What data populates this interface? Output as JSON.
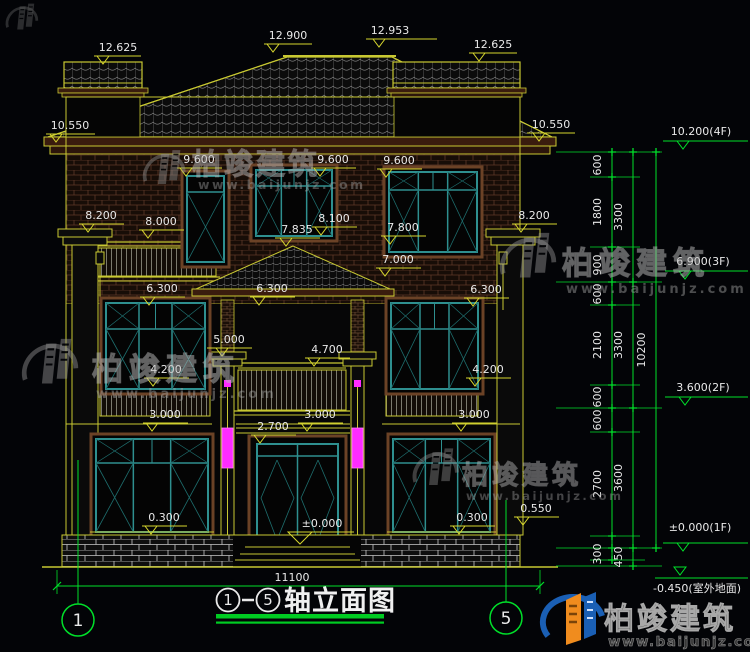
{
  "drawing_title": {
    "bubble_left": "1",
    "bubble_right": "5",
    "label": "轴立面图"
  },
  "brand": {
    "name_cn": "柏竣建筑",
    "website": "www.baijunjz.com"
  },
  "bottom_dim": {
    "text": "11100",
    "x": 292,
    "y": 581
  },
  "axis_bubbles": [
    {
      "label": "1",
      "cx": 78,
      "cy": 620
    },
    {
      "label": "5",
      "cx": 506,
      "cy": 618
    }
  ],
  "yellow_level_marks": [
    {
      "text": "12.625",
      "x": 118,
      "y": 51,
      "line": [
        94,
        141,
        56
      ],
      "tc": 103
    },
    {
      "text": "12.900",
      "x": 288,
      "y": 39,
      "line": [
        264,
        312,
        44
      ],
      "tc": 273
    },
    {
      "text": "12.953",
      "x": 390,
      "y": 34,
      "line": [
        366,
        437,
        39
      ],
      "tc": 379
    },
    {
      "text": "12.625",
      "x": 493,
      "y": 48,
      "line": [
        469,
        517,
        53
      ],
      "tc": 479
    },
    {
      "text": "10.550",
      "x": 70,
      "y": 129,
      "line": [
        46,
        95,
        134
      ],
      "tc": 56
    },
    {
      "text": "10.550",
      "x": 551,
      "y": 128,
      "line": [
        527,
        575,
        133
      ],
      "tc": 539
    },
    {
      "text": "9.600",
      "x": 199,
      "y": 163,
      "line": [
        177,
        222,
        168
      ],
      "tc": 186
    },
    {
      "text": "9.600",
      "x": 333,
      "y": 163,
      "line": [
        311,
        356,
        168
      ],
      "tc": 320
    },
    {
      "text": "9.600",
      "x": 399,
      "y": 164,
      "line": [
        377,
        422,
        169
      ],
      "tc": 386
    },
    {
      "text": "8.200",
      "x": 101,
      "y": 219,
      "line": [
        79,
        124,
        224
      ],
      "tc": 88
    },
    {
      "text": "8.000",
      "x": 161,
      "y": 225,
      "line": [
        139,
        184,
        230
      ],
      "tc": 148
    },
    {
      "text": "8.100",
      "x": 334,
      "y": 222,
      "line": [
        312,
        357,
        227
      ],
      "tc": 321
    },
    {
      "text": "7.835",
      "x": 297,
      "y": 233,
      "line": [
        275,
        320,
        238
      ],
      "tc": 286
    },
    {
      "text": "7.800",
      "x": 403,
      "y": 231,
      "line": [
        381,
        426,
        236
      ],
      "tc": 390
    },
    {
      "text": "8.200",
      "x": 534,
      "y": 219,
      "line": [
        512,
        557,
        224
      ],
      "tc": 521
    },
    {
      "text": "7.000",
      "x": 398,
      "y": 263,
      "line": [
        376,
        421,
        268
      ],
      "tc": 385
    },
    {
      "text": "6.300",
      "x": 162,
      "y": 292,
      "line": [
        140,
        185,
        297
      ],
      "tc": 149
    },
    {
      "text": "6.300",
      "x": 272,
      "y": 292,
      "line": [
        250,
        295,
        297
      ],
      "tc": 259
    },
    {
      "text": "6.300",
      "x": 486,
      "y": 293,
      "line": [
        464,
        509,
        298
      ],
      "tc": 473
    },
    {
      "text": "5.000",
      "x": 229,
      "y": 343,
      "line": [
        207,
        252,
        348
      ],
      "tc": 222
    },
    {
      "text": "4.700",
      "x": 327,
      "y": 353,
      "line": [
        305,
        350,
        358
      ],
      "tc": 314
    },
    {
      "text": "4.200",
      "x": 166,
      "y": 373,
      "line": [
        144,
        189,
        378
      ],
      "tc": 153
    },
    {
      "text": "4.200",
      "x": 488,
      "y": 373,
      "line": [
        466,
        511,
        378
      ],
      "tc": 475
    },
    {
      "text": "3.000",
      "x": 165,
      "y": 418,
      "line": [
        143,
        188,
        423
      ],
      "tc": 152
    },
    {
      "text": "3.000",
      "x": 320,
      "y": 418,
      "line": [
        298,
        343,
        423
      ],
      "tc": 307
    },
    {
      "text": "3.000",
      "x": 474,
      "y": 418,
      "line": [
        452,
        497,
        423
      ],
      "tc": 461
    },
    {
      "text": "2.700",
      "x": 273,
      "y": 430,
      "line": [
        251,
        296,
        435
      ],
      "tc": 260
    },
    {
      "text": "0.300",
      "x": 164,
      "y": 521,
      "line": [
        142,
        187,
        526
      ],
      "tc": 151
    },
    {
      "text": "0.300",
      "x": 472,
      "y": 521,
      "line": [
        450,
        495,
        526
      ],
      "tc": 459
    },
    {
      "text": "0.550",
      "x": 536,
      "y": 512,
      "line": [
        514,
        559,
        517
      ],
      "tc": 523
    },
    {
      "text": "±0.000",
      "x": 322,
      "y": 527,
      "line": [
        292,
        354,
        532
      ],
      "tc": 300,
      "big": true
    }
  ],
  "green_vertical_dims": [
    {
      "text": "600",
      "x": 601,
      "y": 165
    },
    {
      "text": "1800",
      "x": 601,
      "y": 212
    },
    {
      "text": "900",
      "x": 601,
      "y": 265
    },
    {
      "text": "600",
      "x": 601,
      "y": 294
    },
    {
      "text": "2100",
      "x": 601,
      "y": 345
    },
    {
      "text": "600",
      "x": 601,
      "y": 397
    },
    {
      "text": "600",
      "x": 601,
      "y": 420
    },
    {
      "text": "2700",
      "x": 601,
      "y": 484
    },
    {
      "text": "300",
      "x": 601,
      "y": 554
    },
    {
      "text": "3300",
      "x": 622,
      "y": 217
    },
    {
      "text": "3300",
      "x": 622,
      "y": 345
    },
    {
      "text": "3600",
      "x": 622,
      "y": 478
    },
    {
      "text": "450",
      "x": 622,
      "y": 557
    },
    {
      "text": "10200",
      "x": 645,
      "y": 350
    }
  ],
  "green_level_marks": [
    {
      "text": "10.200(4F)",
      "x": 701,
      "y": 135,
      "line": [
        663,
        748,
        141
      ],
      "tc": 683
    },
    {
      "text": "6.900(3F)",
      "x": 703,
      "y": 265,
      "line": [
        665,
        748,
        271
      ],
      "tc": 685
    },
    {
      "text": "3.600(2F)",
      "x": 703,
      "y": 391,
      "line": [
        665,
        748,
        397
      ],
      "tc": 685
    },
    {
      "text": "±0.000(1F)",
      "x": 700,
      "y": 531,
      "line": [
        663,
        748,
        543
      ],
      "tc": 683
    },
    {
      "text": "-0.450(室外地面)",
      "x": 697,
      "y": 592,
      "line": [
        655,
        748,
        578
      ],
      "tc": 680,
      "tb": 567
    }
  ],
  "colors": {
    "background": "#030407",
    "cad_yellow": "#d6d62e",
    "cad_green": "#00e02a",
    "cad_white": "#e9e9e9",
    "window_teal": "#2e8f8f",
    "diag_teal": "#1e6e6e",
    "surround_brown": "#6b4226",
    "lamp_magenta": "#ff2bff",
    "eave_maroon": "#3a1c0e",
    "logo_blue": "#1a5fb4",
    "logo_orange": "#f08c1e"
  }
}
